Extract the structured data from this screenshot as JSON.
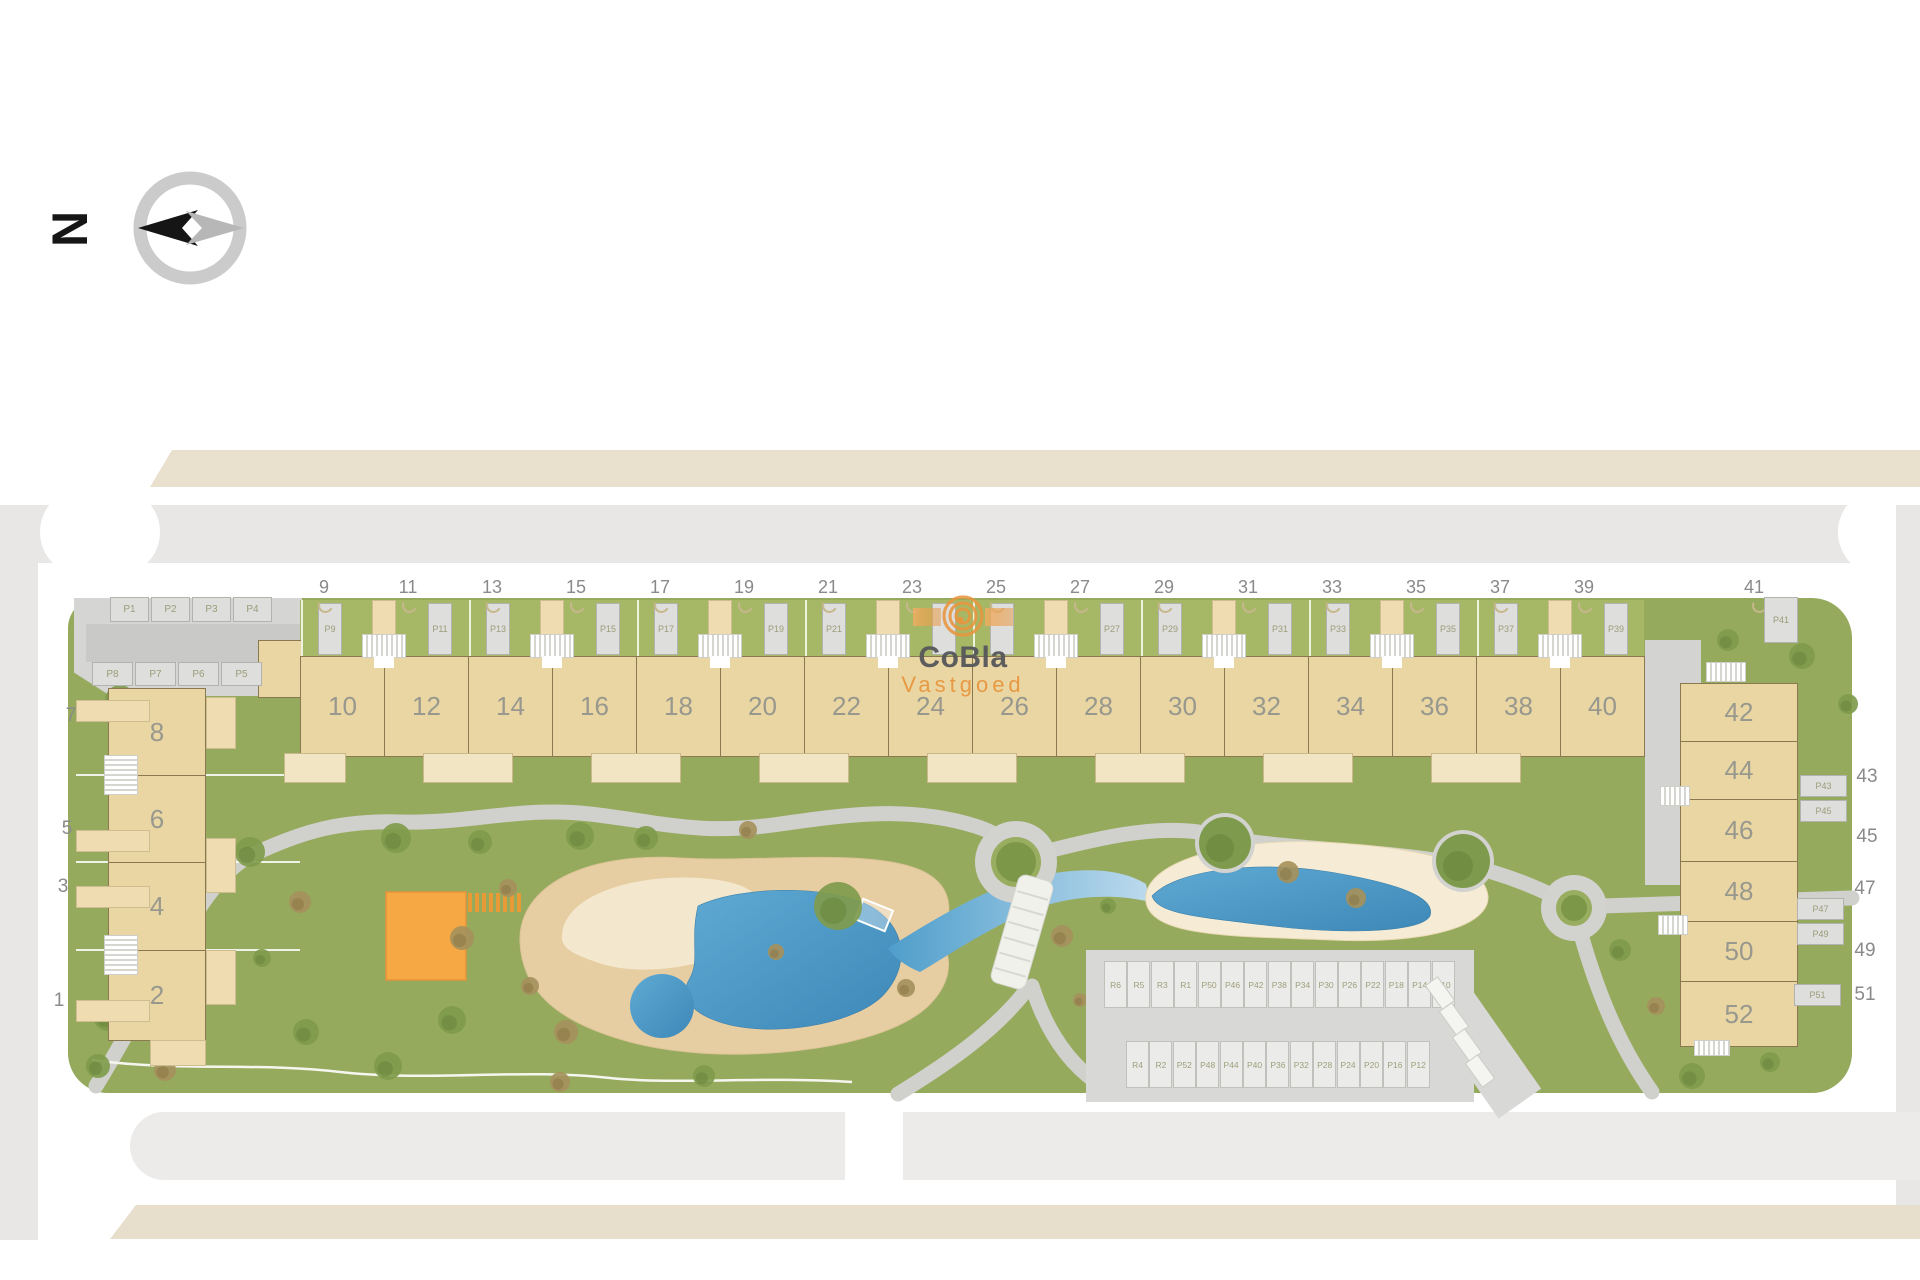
{
  "palette": {
    "lawn": "#96aa5d",
    "yard": "#a6b866",
    "building": "#e9d6a3",
    "building_light": "#f2e5c4",
    "pool": "#4a9cc9",
    "stream_light": "#bcdaed",
    "sand": "#e7cda2",
    "sand_light": "#f3e8cd",
    "sand_right": "#f6ecd5",
    "deck_orange": "#f6a845",
    "road_gray": "#e8e7e5",
    "pad_gray": "#d7d7d5",
    "beige_strip": "#e9e0cd",
    "brand_orange": "#e8963e",
    "brand_gray": "#56575a",
    "number_gray": "#8a8a8a"
  },
  "compass": {
    "north_label": "N"
  },
  "watermark": {
    "brand": "CoBla",
    "sub": "Vastgoed"
  },
  "west_parking": {
    "row1": [
      "P1",
      "P2",
      "P3",
      "P4"
    ],
    "row2": [
      "P8",
      "P7",
      "P6",
      "P5"
    ]
  },
  "west_block": {
    "units": [
      "8",
      "6",
      "4",
      "2"
    ],
    "street_numbers": [
      "7",
      "5",
      "3",
      "1"
    ]
  },
  "north_row": {
    "street_numbers": [
      "9",
      "11",
      "13",
      "15",
      "17",
      "19",
      "21",
      "23",
      "25",
      "27",
      "29",
      "31",
      "33",
      "35",
      "37",
      "39"
    ],
    "units": [
      "10",
      "12",
      "14",
      "16",
      "18",
      "20",
      "22",
      "24",
      "26",
      "28",
      "30",
      "32",
      "34",
      "36",
      "38",
      "40"
    ],
    "parking": [
      "P9",
      "P11",
      "P13",
      "P15",
      "P17",
      "P19",
      "P21",
      "",
      "",
      "P27",
      "P29",
      "P31",
      "P33",
      "P35",
      "P37",
      "P39"
    ]
  },
  "east_block": {
    "units": [
      "42",
      "44",
      "46",
      "48",
      "50",
      "52"
    ],
    "street_numbers": [
      "41",
      "43",
      "45",
      "47",
      "49",
      "51"
    ],
    "parking": [
      "P41",
      "P43",
      "P45",
      "P47",
      "P49",
      "P51"
    ]
  },
  "central_parking": {
    "row1": [
      "R6",
      "R5",
      "R3",
      "R1",
      "P50",
      "P46",
      "P42",
      "P38",
      "P34",
      "P30",
      "P26",
      "P22",
      "P18",
      "P14",
      "P10"
    ],
    "row2": [
      "R4",
      "R2",
      "P52",
      "P48",
      "P44",
      "P40",
      "P36",
      "P32",
      "P28",
      "P24",
      "P20",
      "P16",
      "P12"
    ]
  }
}
